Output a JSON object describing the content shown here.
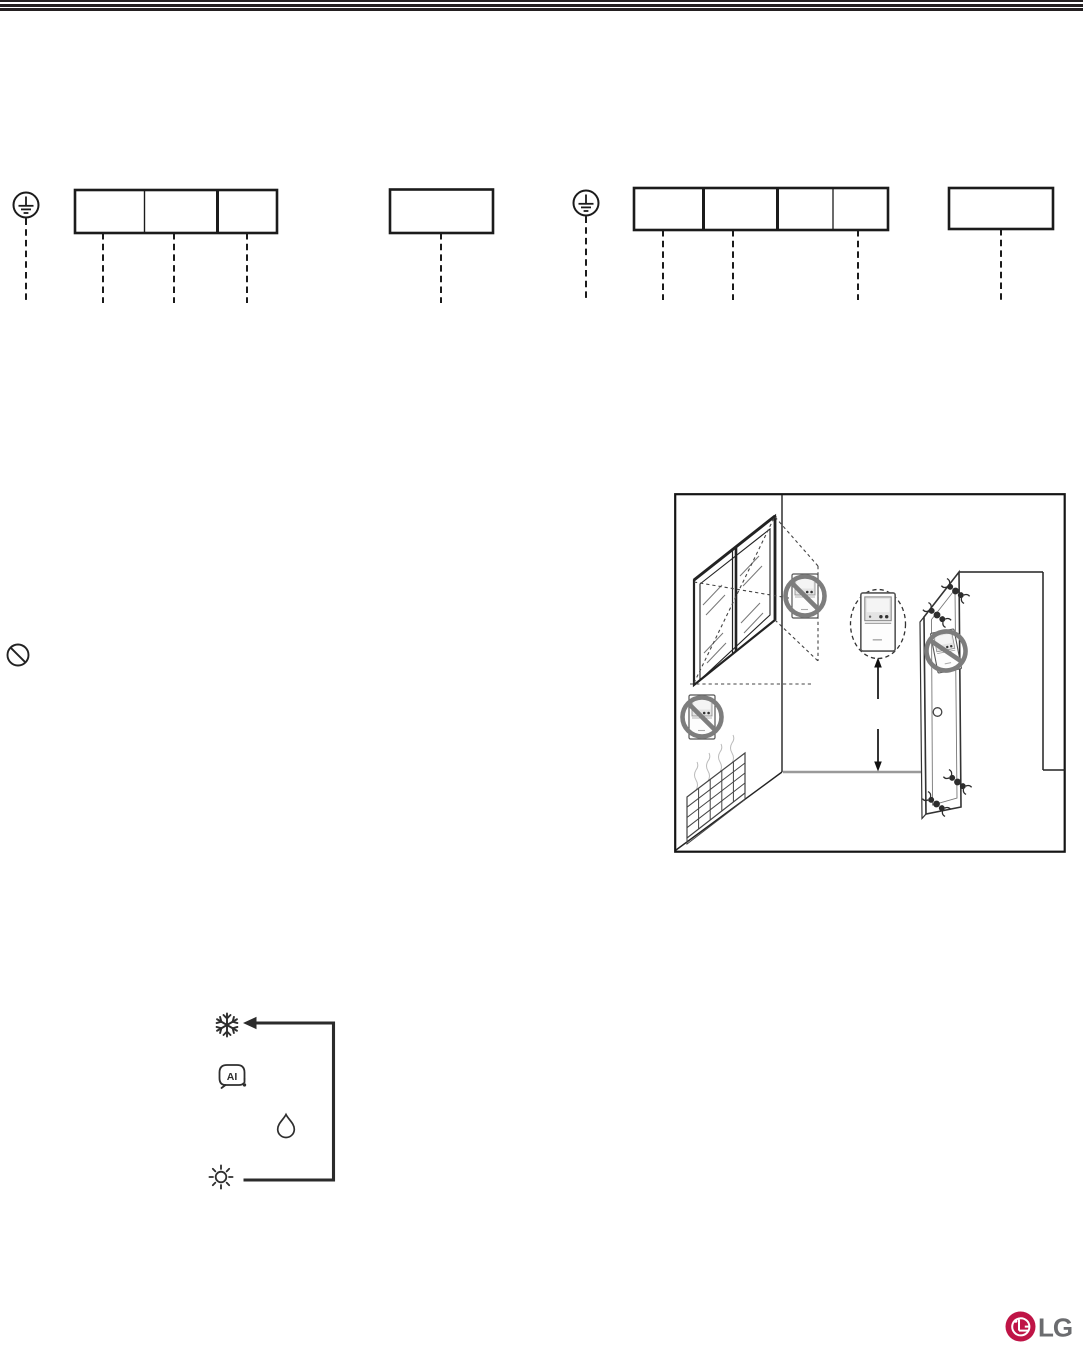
{
  "page": {
    "kind": "appliance-manual-page",
    "background_color": "#ffffff"
  },
  "header_rule": {
    "stripe_count": 3,
    "color": "#231f20"
  },
  "wiring_section": {
    "line_color": "#1b1b1b",
    "left_group": {
      "ground_icon": "protective-earth-icon",
      "terminal_block": {
        "cells": 3,
        "dashed_leads": 3
      },
      "single_block": {
        "cells": 1,
        "dashed_leads": 1
      }
    },
    "right_group": {
      "ground_icon": "protective-earth-icon",
      "terminal_block": {
        "cells": 4,
        "dashed_leads": 3
      },
      "single_block": {
        "cells": 1,
        "dashed_leads": 1
      }
    }
  },
  "caution_marker": {
    "icon": "prohibition-circle-slash-icon",
    "color": "#222222"
  },
  "installation_illustration": {
    "subject": "remote-controller-mounting-locations",
    "prohibition_color": "#7d7d7d",
    "elements": [
      "window-with-sunlight",
      "sunlight-projection-dashed-lines",
      "prohibited-controller-in-sunlight",
      "prohibited-controller-near-window",
      "recommended-controller-dashed-circle",
      "mounting-height-arrows",
      "door-with-ornate-hinges",
      "prohibited-controller-on-door",
      "radiator-heat-source"
    ]
  },
  "mode_cycle_diagram": {
    "arrow_color": "#2b2b2b",
    "icon_color": "#2e2e2e",
    "sequence": [
      {
        "icon": "cooling-snowflake-icon",
        "label": ""
      },
      {
        "icon": "ai-mode-icon",
        "label": "AI"
      },
      {
        "icon": "dehumidify-drop-icon",
        "label": ""
      },
      {
        "icon": "heating-sun-icon",
        "label": ""
      }
    ],
    "loop": "heating-back-to-cooling"
  },
  "footer": {
    "logo": {
      "text": "LG",
      "emblem": "lg-face-emblem",
      "emblem_color": "#bf1446",
      "text_color": "#6b6c6f"
    }
  }
}
